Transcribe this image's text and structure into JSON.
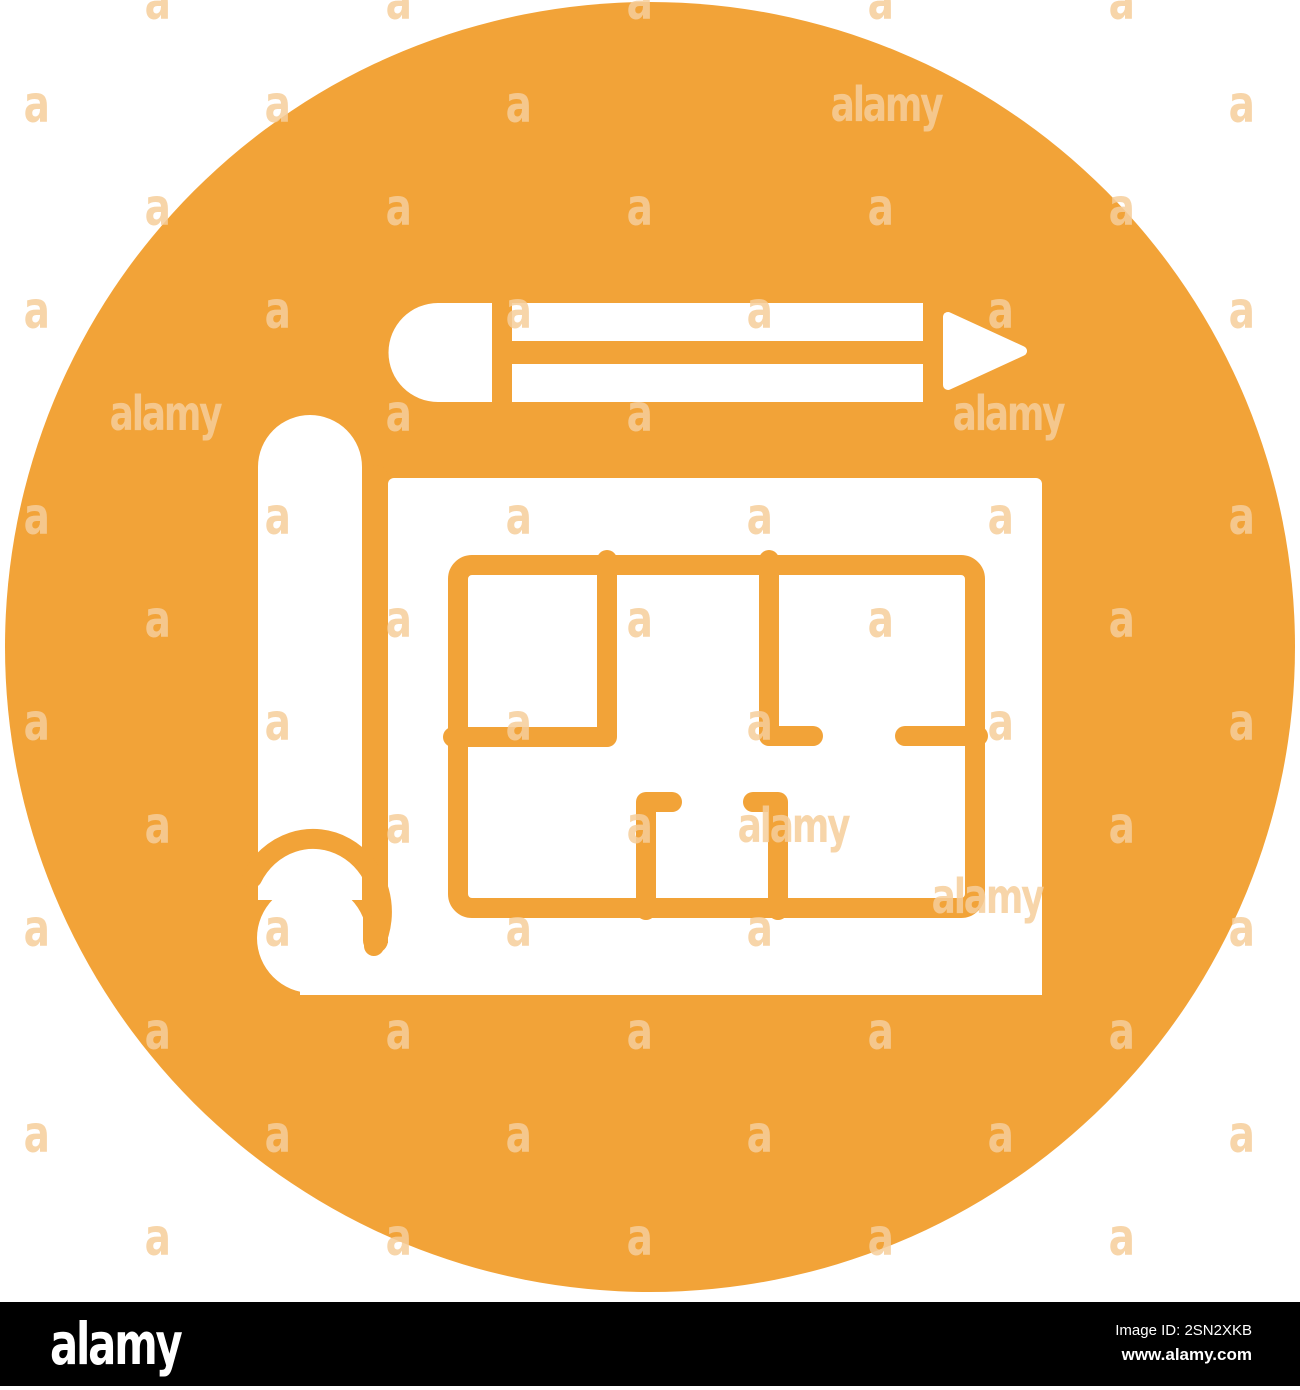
{
  "page": {
    "background": "#ffffff"
  },
  "icon": {
    "name": "blueprint-floor-plan-with-pencil",
    "colors": {
      "orange": "#F2A338",
      "white": "#FFFFFF"
    }
  },
  "watermark": {
    "color": "#F6CE9B",
    "glyph": "a",
    "word": "alamy",
    "lattice": {
      "rows": 13,
      "row_start": 2,
      "row_step": 103,
      "x_offsets_a": [
        36,
        277,
        518,
        759,
        1000,
        1241
      ],
      "x_offsets_b": [
        157,
        398,
        639,
        880,
        1121
      ],
      "skip": [
        "1:759",
        "1:1000",
        "4:157",
        "4:880",
        "4:1121",
        "8:880",
        "9:1000"
      ]
    },
    "words": [
      {
        "x": 886,
        "y": 105
      },
      {
        "x": 165,
        "y": 414
      },
      {
        "x": 1008,
        "y": 414
      },
      {
        "x": 793,
        "y": 826
      },
      {
        "x": 987,
        "y": 897
      }
    ]
  },
  "footer": {
    "bar_color": "#000000",
    "text_color": "#ffffff",
    "logo_text": "alamy",
    "image_id_text": "Image ID: 2SN2XKB",
    "url_text": "www.alamy.com"
  }
}
